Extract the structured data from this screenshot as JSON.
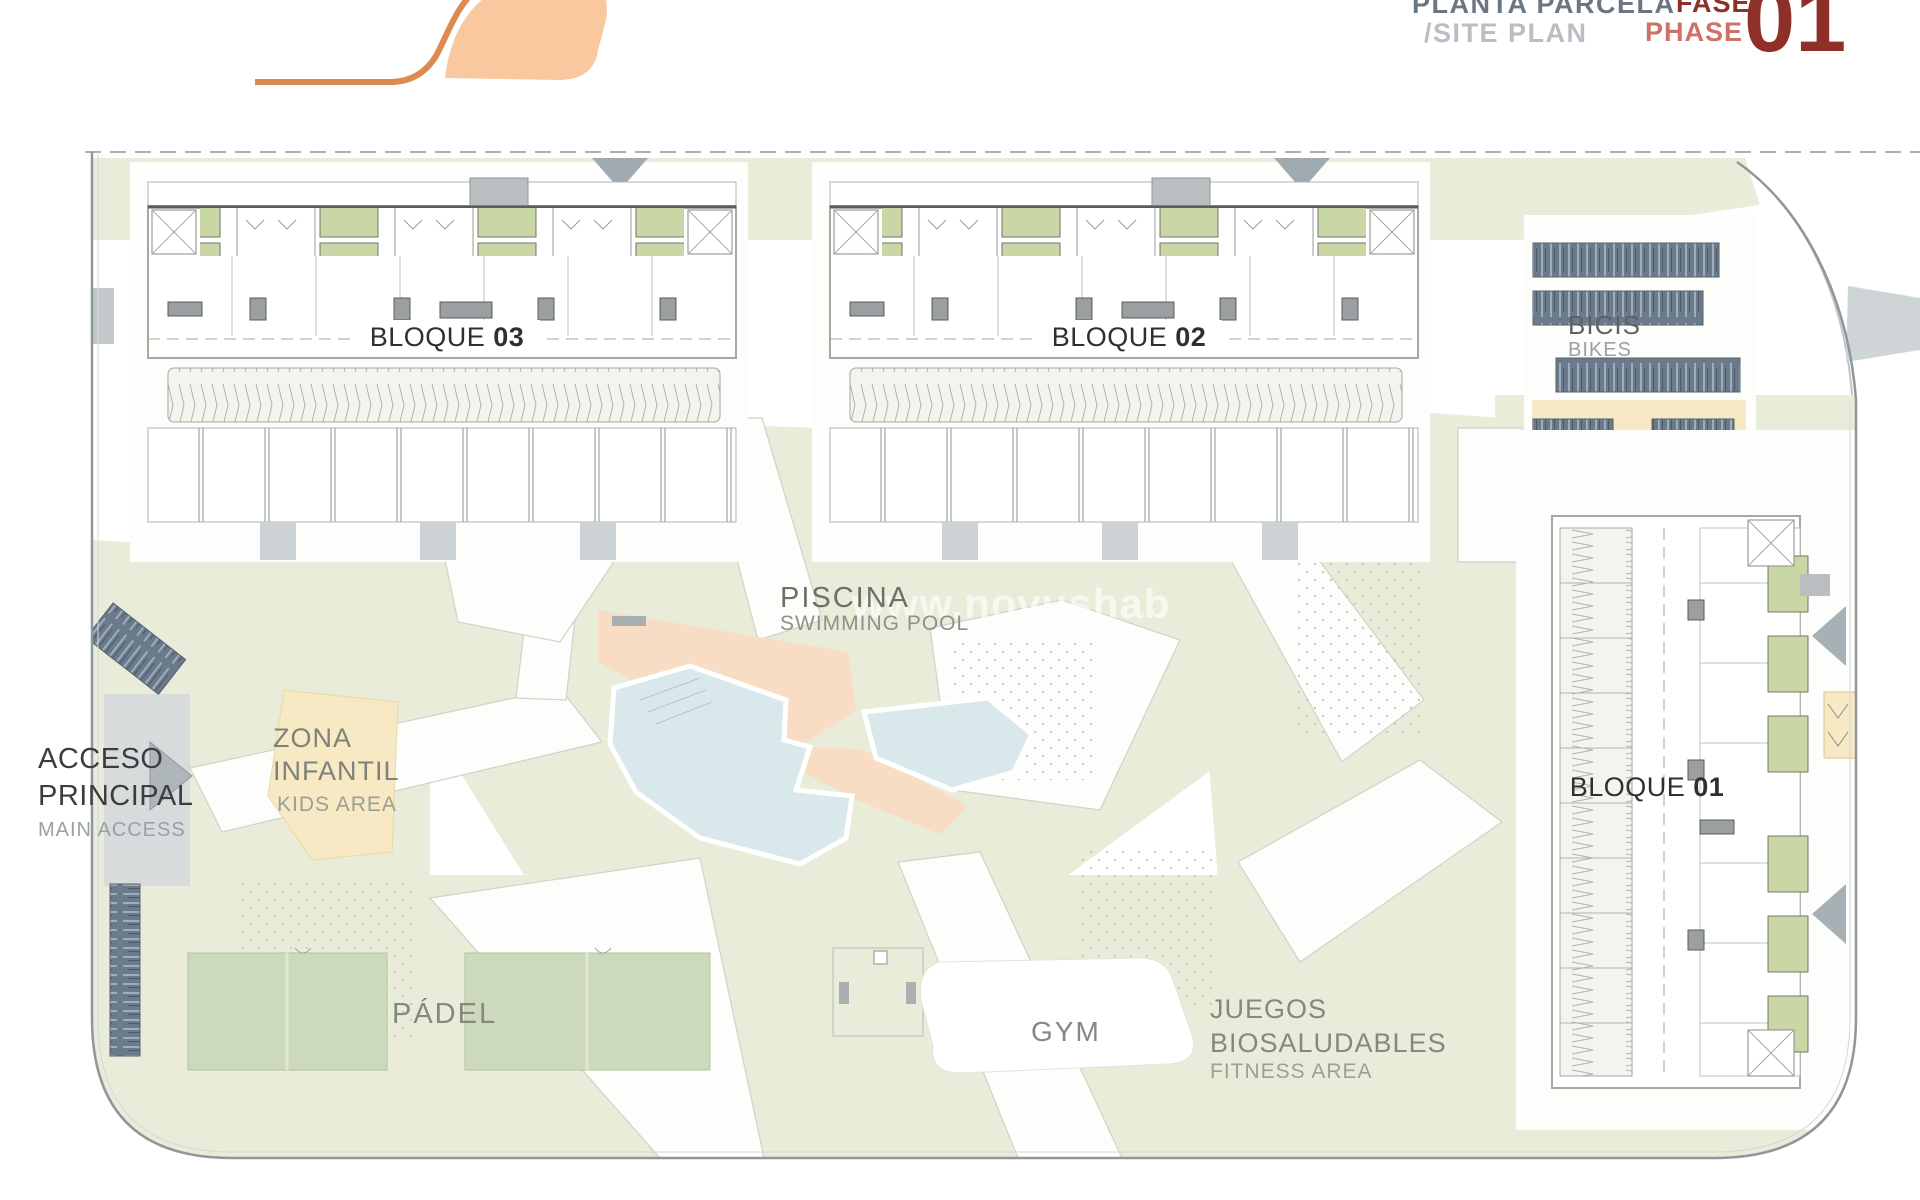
{
  "header": {
    "title_es": "PLANTA PARCELA",
    "title_en": "/SITE PLAN",
    "phase_es": "FASE",
    "phase_en": "PHASE",
    "phase_number": "01"
  },
  "watermark": "www.novushab",
  "labels": {
    "bloque03": {
      "name": "BLOQUE",
      "num": "03"
    },
    "bloque02": {
      "name": "BLOQUE",
      "num": "02"
    },
    "bloque01": {
      "name": "BLOQUE",
      "num": "01"
    },
    "bikes": {
      "es": "BICIS",
      "en": "BIKES"
    },
    "pool": {
      "es": "PISCINA",
      "en": "SWIMMING POOL"
    },
    "kids": {
      "line1": "ZONA",
      "line2": "INFANTIL",
      "en": "KIDS AREA"
    },
    "access": {
      "line1": "ACCESO",
      "line2": "PRINCIPAL",
      "en": "MAIN ACCESS"
    },
    "padel": {
      "es": "PÁDEL"
    },
    "gym": {
      "es": "GYM"
    },
    "fitness": {
      "line1": "JUEGOS",
      "line2": "BIOSALUDABLES",
      "en": "FITNESS AREA"
    }
  },
  "colors": {
    "phase_dark": "#8e2f28",
    "phase_light": "#ce7166",
    "title_dark": "#6b7683",
    "title_light": "#b9bec5",
    "logo_orange": "#dd8a52",
    "logo_fill": "#f9c89e",
    "landscape_green": "#e9ecd9",
    "court_green": "#ccd9bb",
    "balcony_green": "#c9d6a6",
    "pool_water": "#d9e8ea",
    "pool_deck": "#f8dcc3",
    "kids_yellow": "#f6e9c3",
    "bike_rack_navy": "#6a7a8b",
    "road_gray": "#d8dbdc"
  }
}
